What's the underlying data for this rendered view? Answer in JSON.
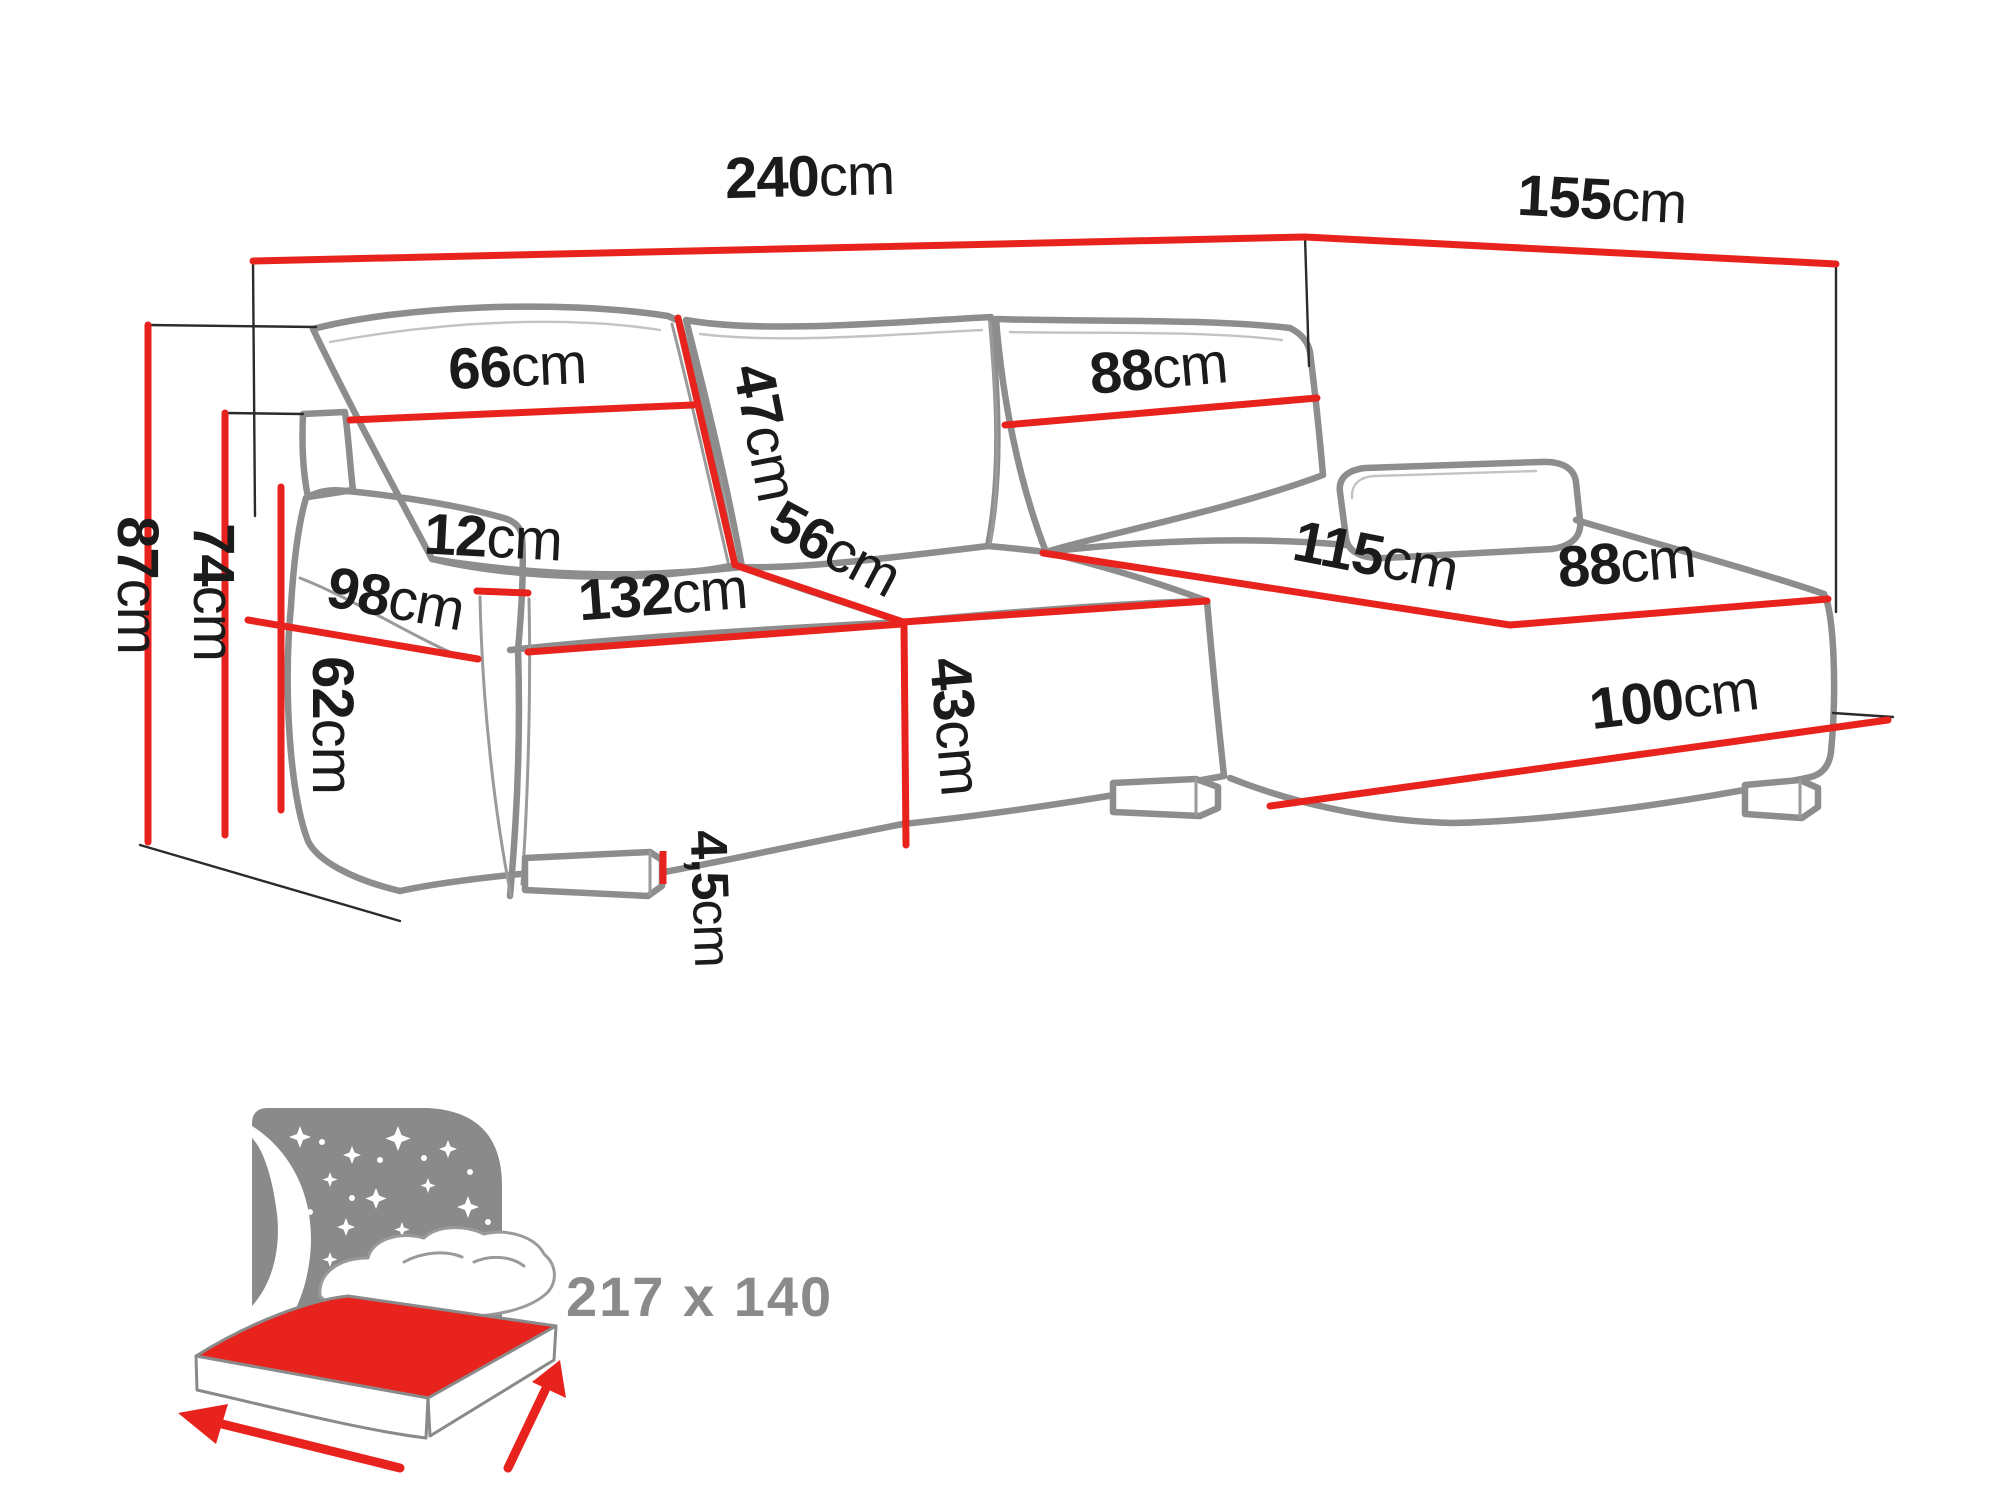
{
  "palette": {
    "dimension_red": "#e8231d",
    "sketch_gray": "#8d8d8d",
    "label_black": "#1b1b1b",
    "icon_gray": "#8a8a8a",
    "background": "#ffffff"
  },
  "diagram": {
    "type": "furniture-dimension-diagram",
    "subject": "corner sofa bed with chaise",
    "dimensions": {
      "total_width": {
        "value": "240",
        "unit": "cm"
      },
      "total_depth": {
        "value": "155",
        "unit": "cm"
      },
      "total_height": {
        "value": "87",
        "unit": "cm"
      },
      "backrest_height": {
        "value": "74",
        "unit": "cm"
      },
      "armrest_height": {
        "value": "62",
        "unit": "cm"
      },
      "back_cushion_left_width": {
        "value": "66",
        "unit": "cm"
      },
      "back_cushion_height": {
        "value": "47",
        "unit": "cm"
      },
      "back_cushion_right_width": {
        "value": "88",
        "unit": "cm"
      },
      "armrest_top_width": {
        "value": "12",
        "unit": "cm"
      },
      "seat_depth": {
        "value": "98",
        "unit": "cm"
      },
      "seat_width": {
        "value": "132",
        "unit": "cm"
      },
      "corner_seat_width": {
        "value": "56",
        "unit": "cm"
      },
      "seat_height": {
        "value": "43",
        "unit": "cm"
      },
      "leg_height": {
        "value": "4,5",
        "unit": "cm"
      },
      "chaise_length": {
        "value": "115",
        "unit": "cm"
      },
      "chaise_width": {
        "value": "88",
        "unit": "cm"
      },
      "chaise_base_length": {
        "value": "100",
        "unit": "cm"
      }
    },
    "sleeping_function": {
      "size_label": "217 x 140"
    }
  }
}
